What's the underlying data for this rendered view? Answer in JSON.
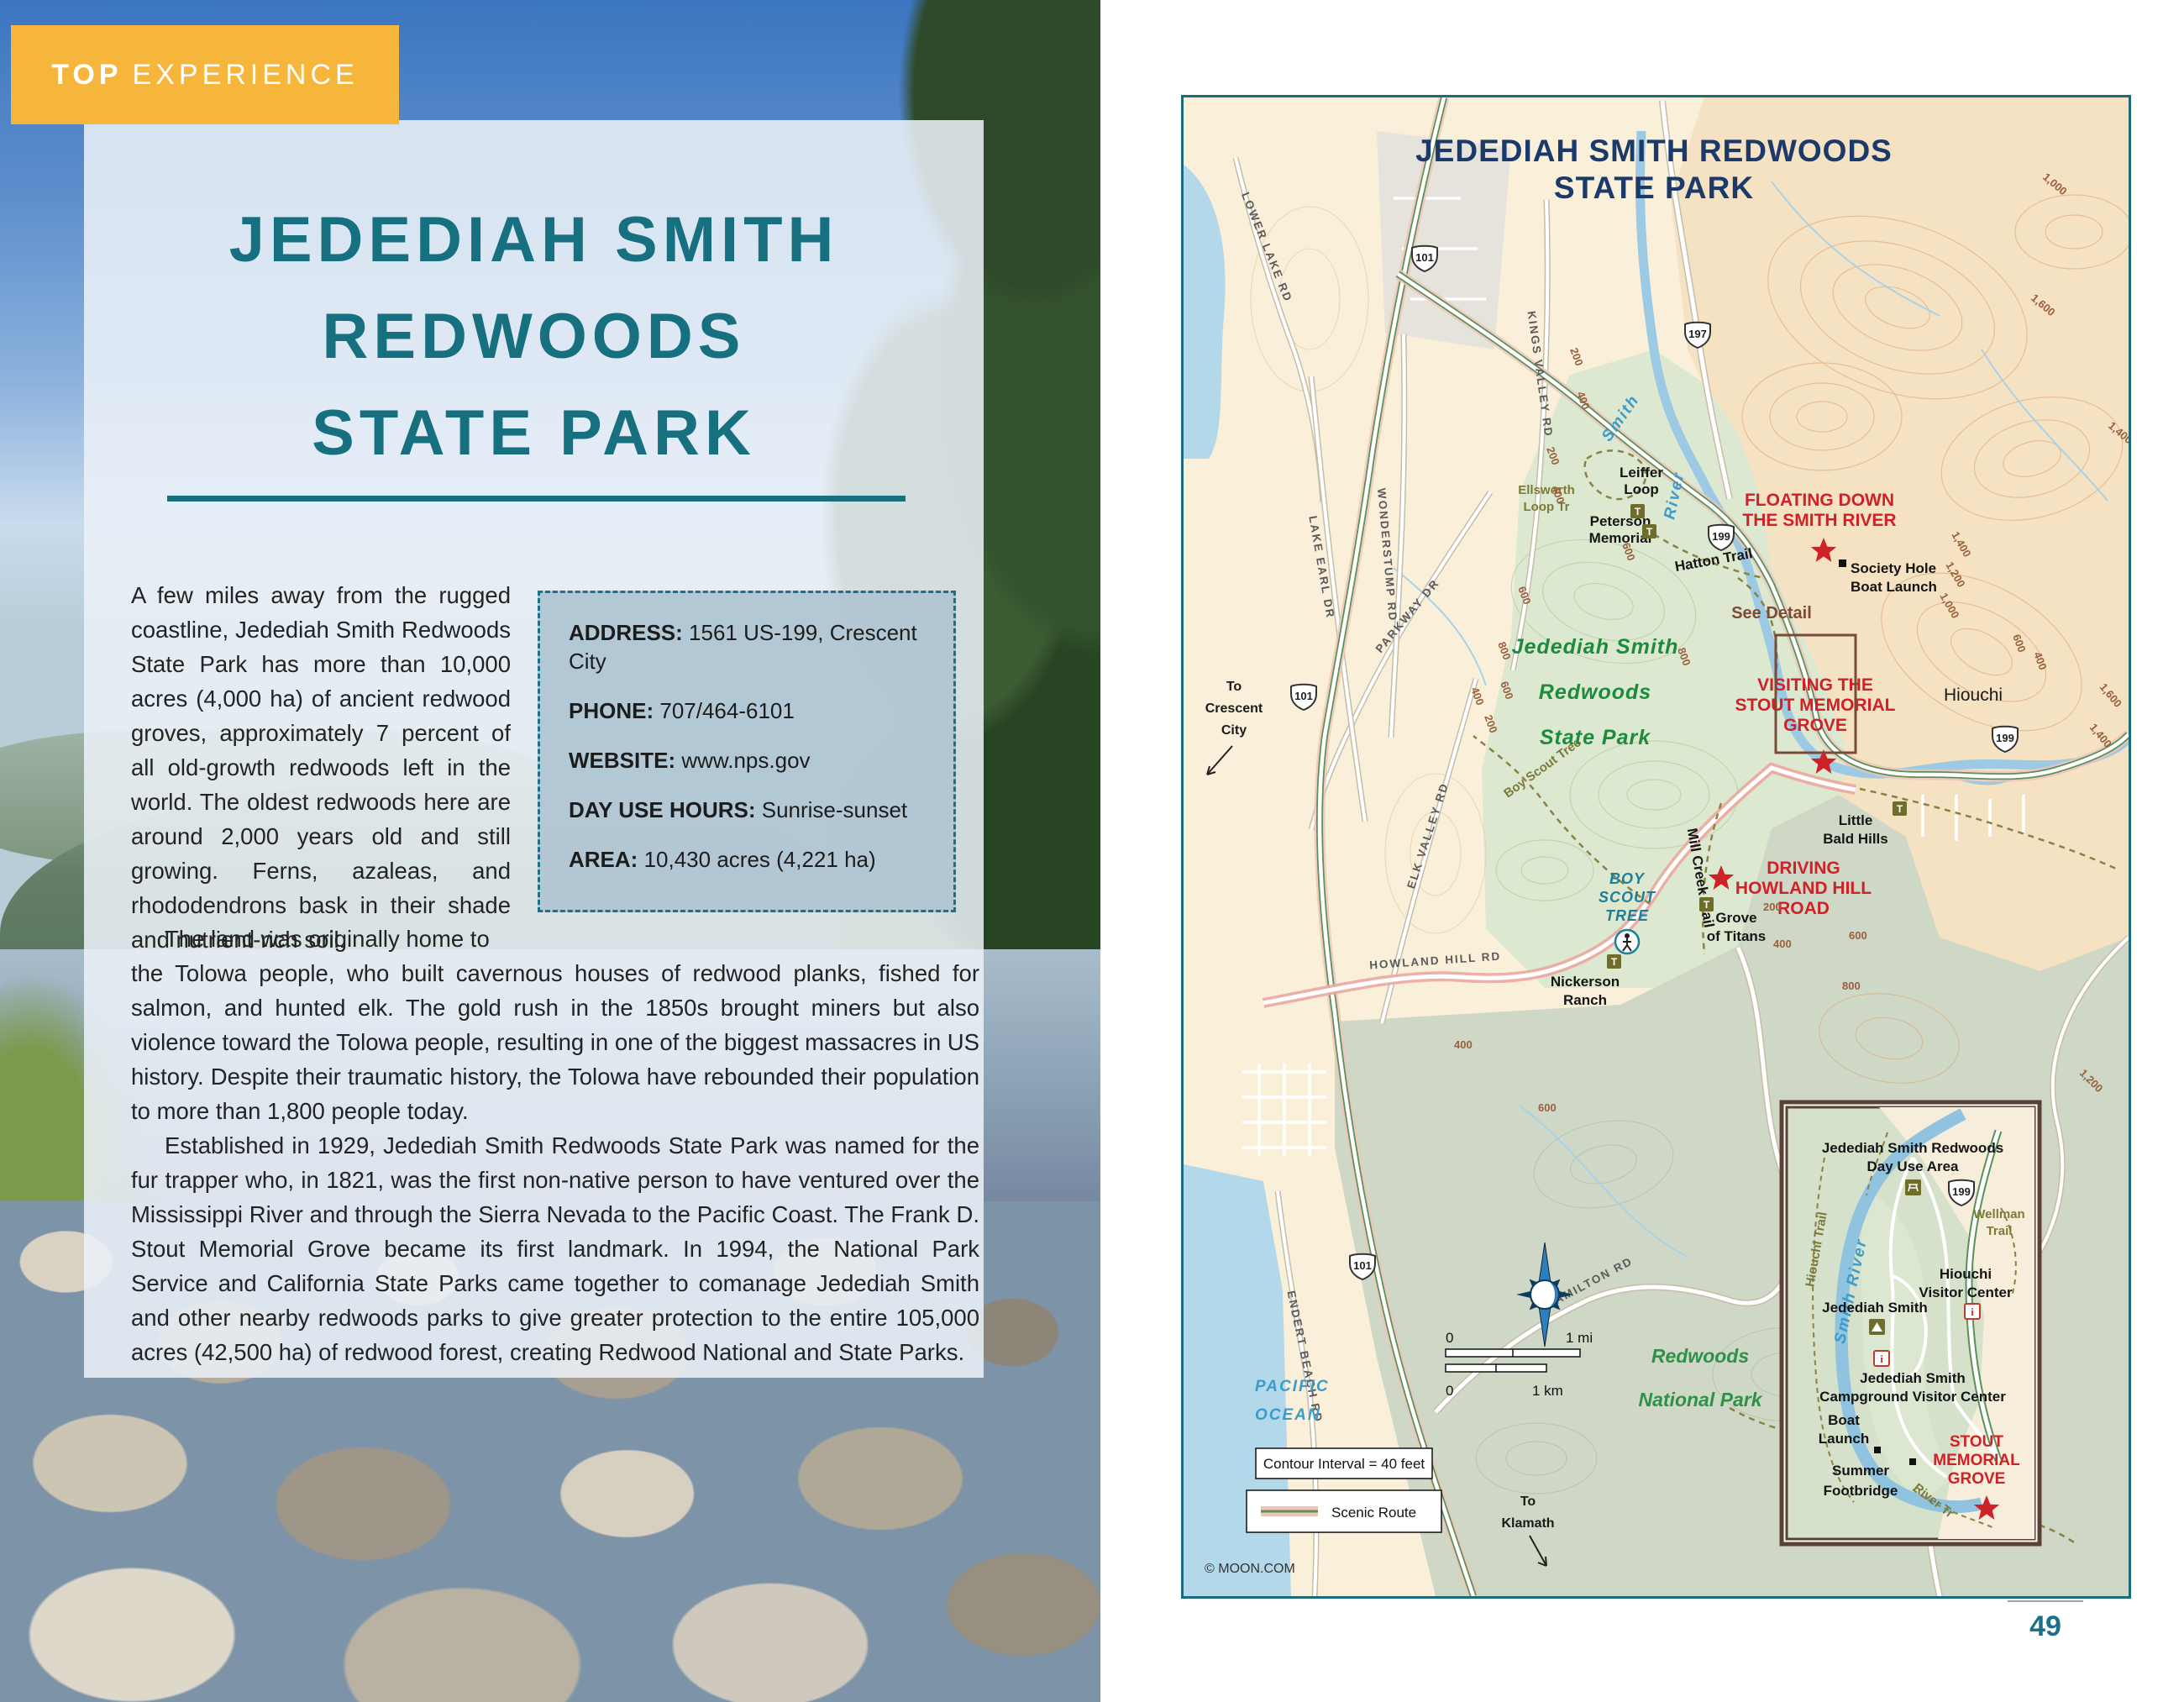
{
  "badge": {
    "top": "TOP",
    "experience": "EXPERIENCE"
  },
  "article": {
    "title1": "JEDEDIAH SMITH",
    "title2": "REDWOODS",
    "title3": "STATE PARK",
    "para1": "A few miles away from the rugged coastline, Jedediah Smith Redwoods State Park has more than 10,000 acres (4,000 ha) of ancient redwood groves, approximately 7 percent of all old-growth redwoods left in the world. The oldest redwoods here are around 2,000 years old and still growing. Ferns, azaleas, and rhododendrons bask in their shade and nutrient-rich soil.",
    "para2_lead": "The land was originally home to",
    "para2_rest": "the Tolowa people, who built cavernous houses of redwood planks, fished for salmon, and hunted elk. The gold rush in the 1850s brought miners but also violence toward the Tolowa people, resulting in one of the biggest massacres in US history. Despite their traumatic history, the Tolowa have rebounded their population to more than 1,800 people today.",
    "para3": "Established in 1929, Jedediah Smith Redwoods State Park was named for the fur trapper who, in 1821, was the first non-native person to have ventured over the Mississippi River and through the Sierra Nevada to the Pacific Coast. The Frank D. Stout Memorial Grove became its first landmark. In 1994, the National Park Service and California State Parks came together to comanage Jedediah Smith and other nearby redwoods parks to give greater protection to the entire 105,000 acres (42,500 ha) of redwood forest, creating Redwood National and State Parks."
  },
  "infobox": {
    "address_label": "ADDRESS:",
    "address": "1561 US-199, Crescent City",
    "phone_label": "PHONE:",
    "phone": "707/464-6101",
    "website_label": "WEBSITE:",
    "website": "www.nps.gov",
    "hours_label": "DAY USE HOURS:",
    "hours": "Sunrise-sunset",
    "area_label": "AREA:",
    "area": "10,430 acres (4,221 ha)"
  },
  "map": {
    "title_line1": "JEDEDIAH SMITH REDWOODS",
    "title_line2": "STATE PARK",
    "shields": {
      "us101": "101",
      "us197": "197",
      "us199": "199"
    },
    "icons": {
      "trailhead": "T",
      "info": "i"
    },
    "labels": {
      "lower_lake_rd": "LOWER LAKE RD",
      "lake_earl_dr": "LAKE EARL DR",
      "wonderstump_rd": "WONDERSTUMP RD",
      "kings_valley_rd": "KINGS VALLEY RD",
      "parkway_dr": "PARKWAY DR",
      "elk_valley_rd": "ELK VALLEY RD",
      "howland_hill_rd": "HOWLAND HILL RD",
      "endert_beach_rd": "ENDERT BEACH RD",
      "hamilton_rd": "HAMILTON RD",
      "smith": "Smith",
      "river": "River",
      "leiffer": [
        "Leiffer",
        "Loop"
      ],
      "ellsworth": [
        "Ellsworth",
        "Loop Tr"
      ],
      "peterson": [
        "Peterson",
        "Memorial"
      ],
      "floating": [
        "FLOATING DOWN",
        "THE SMITH RIVER"
      ],
      "society": [
        "Society Hole",
        "Boat Launch"
      ],
      "hatton": "Hatton Trail",
      "see_detail": "See Detail",
      "park": [
        "Jedediah Smith",
        "Redwoods",
        "State Park"
      ],
      "visiting": [
        "VISITING THE",
        "STOUT MEMORIAL",
        "GROVE"
      ],
      "hiouchi": "Hiouchi",
      "little_bald": [
        "Little",
        "Bald Hills"
      ],
      "driving": [
        "DRIVING",
        "HOWLAND HILL",
        "ROAD"
      ],
      "boy_scout_poi": [
        "BOY",
        "SCOUT",
        "TREE"
      ],
      "grove": [
        "Grove",
        "of Titans"
      ],
      "nickerson": [
        "Nickerson",
        "Ranch"
      ],
      "mill_creek": "Mill Creek Trail",
      "boy_scout_trail": "Boy Scout Tree",
      "to_crescent": [
        "To",
        "Crescent",
        "City"
      ],
      "pacific": [
        "PACIFIC",
        "OCEAN"
      ],
      "rnp": [
        "Redwoods",
        "National Park"
      ],
      "to_klamath": [
        "To",
        "Klamath"
      ]
    },
    "inset": {
      "day_use": [
        "Jedediah Smith Redwoods",
        "Day Use Area"
      ],
      "hiouchi_trail": "Hiouchi Trail",
      "smith_river": "Smith River",
      "wellman": [
        "Wellman",
        "Trail"
      ],
      "hiouchi_vc": [
        "Hiouchi",
        "Visitor Center"
      ],
      "jed_smith": "Jedediah Smith",
      "cg_vc": [
        "Jedediah Smith",
        "Campground Visitor Center"
      ],
      "boat_launch": [
        "Boat",
        "Launch"
      ],
      "summer_fb": [
        "Summer",
        "Footbridge"
      ],
      "river_tr": "River Tr",
      "stout": [
        "STOUT",
        "MEMORIAL",
        "GROVE"
      ]
    },
    "contours": [
      "200",
      "400",
      "200",
      "400",
      "600",
      "800",
      "600",
      "400",
      "200",
      "1,000",
      "1,600",
      "1,400",
      "1,400",
      "1,200",
      "1,000",
      "600",
      "400",
      "1,600",
      "1,400",
      "200",
      "400",
      "600",
      "800",
      "1,200",
      "800",
      "600",
      "400",
      "600"
    ],
    "legend": {
      "contour_interval": "Contour Interval = 40 feet",
      "scenic_route": "Scenic Route",
      "mi0": "0",
      "mi1": "1 mi",
      "km0": "0",
      "km1": "1 km"
    },
    "credit": "© MOON.COM"
  },
  "page_number": "49"
}
